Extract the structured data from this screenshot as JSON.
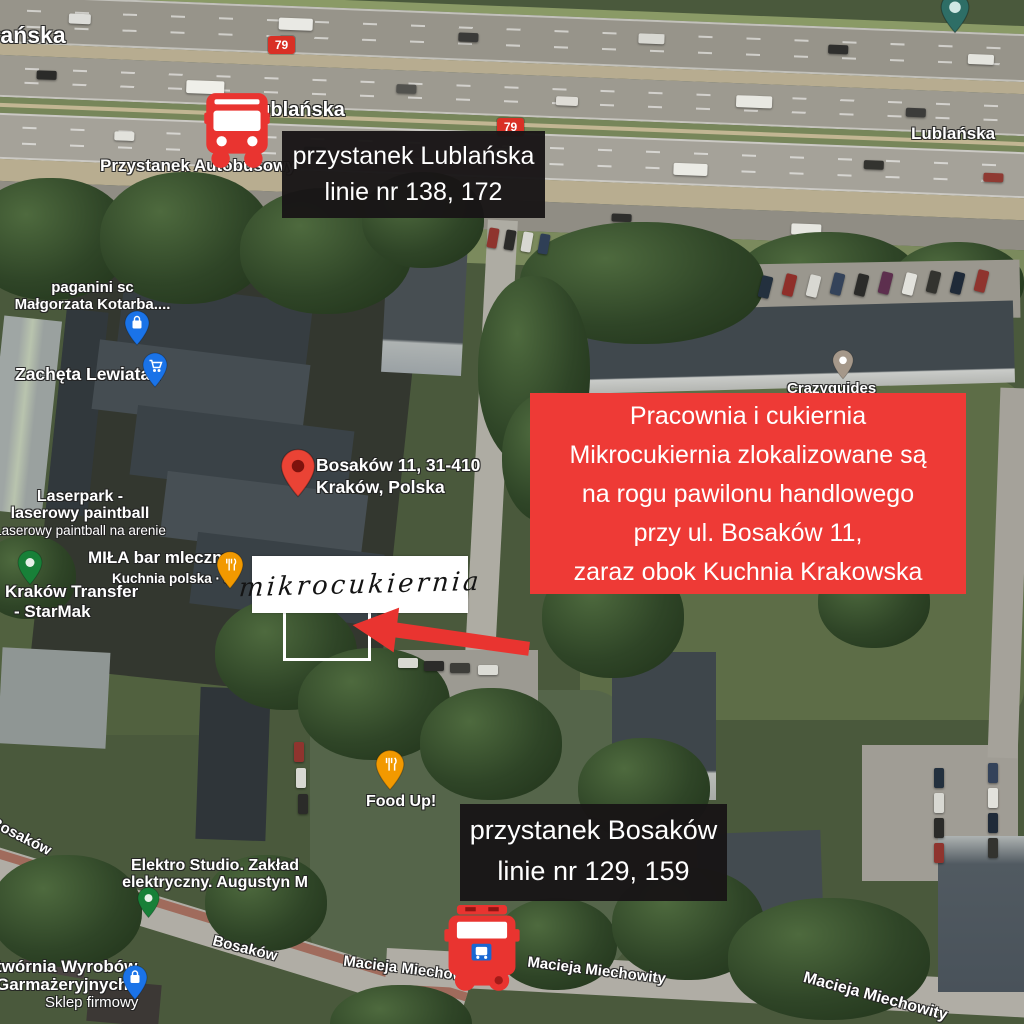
{
  "annotations": {
    "stop_lublanska": {
      "line1": "przystanek Lublańska",
      "line2": "linie nr 138, 172"
    },
    "stop_bosakow": {
      "line1": "przystanek Bosaków",
      "line2": "linie nr 129, 159"
    },
    "info_box": {
      "line1": "Pracownia i cukiernia",
      "line2": "Mikrocukiernia zlokalizowane są",
      "line3": "na rogu pawilonu handlowego",
      "line4": "przy ul. Bosaków 11,",
      "line5": "zaraz obok Kuchnia Krakowska"
    },
    "handwritten_label": "mikrocukiernia"
  },
  "map_labels": {
    "lublanska_topleft": "łańska",
    "lublanska_center": "Lublańska",
    "lublanska_right": "Lublańska",
    "route_79_a": "79",
    "route_79_b": "79",
    "przystanek_autobusowy": "Przystanek Autobusowy",
    "paganini_line1": "paganini sc",
    "paganini_line2": "Małgorzata Kotarba....",
    "zacheta": "Zachęta Lewiatan",
    "bosakow11_line1": "Bosaków 11, 31-410",
    "bosakow11_line2": "Kraków, Polska",
    "laserpark_line1": "Laserpark -",
    "laserpark_line2": "laserowy paintball",
    "laserpark_line3": "Laserowy paintball na arenie",
    "mila": "MIŁA bar mleczny",
    "mila_sub": "Kuchnia polska · $",
    "krakow_transfer_line1": "Kraków Transfer",
    "krakow_transfer_line2": "- StarMak",
    "crazyguides": "Crazyguides",
    "food_up": "Food Up!",
    "elektro_line1": "Elektro Studio. Zakład",
    "elektro_line2": "elektryczny. Augustyn M",
    "wytwornia_line1": "twórnia Wyrobów",
    "wytwornia_line2": "Garmażeryjnych",
    "wytwornia_sub": "Sklep firmowy",
    "bosakow_street_upper": "Bosaków",
    "bosakow_street_lower": "Bosaków",
    "macieja_left": "Macieja Miechow",
    "macieja_center": "Macieja Miechowity",
    "macieja_bottomright": "Macieja Miechowity"
  },
  "icons": {
    "bus": "bus-icon",
    "bus_stop_square": "bus-stop-icon",
    "arrow": "arrow-left-icon",
    "pin_place": "place-pin-icon",
    "pin_shopping_bag": "shopping-pin-icon",
    "pin_cart": "supermarket-pin-icon",
    "pin_restaurant": "restaurant-pin-icon",
    "pin_dot": "generic-pin-icon",
    "pin_transit": "transit-pin-icon"
  },
  "colors": {
    "annotation_red": "#ee3a36",
    "annotation_black": "#181516",
    "bus_red": "#e93430",
    "route_shield_red": "#d93025",
    "pin_blue": "#1a73e8",
    "pin_red": "#ea4335",
    "pin_orange": "#f29900",
    "pin_green": "#188038",
    "pin_grey": "#a5988a",
    "pin_teal": "#2e6e66"
  }
}
